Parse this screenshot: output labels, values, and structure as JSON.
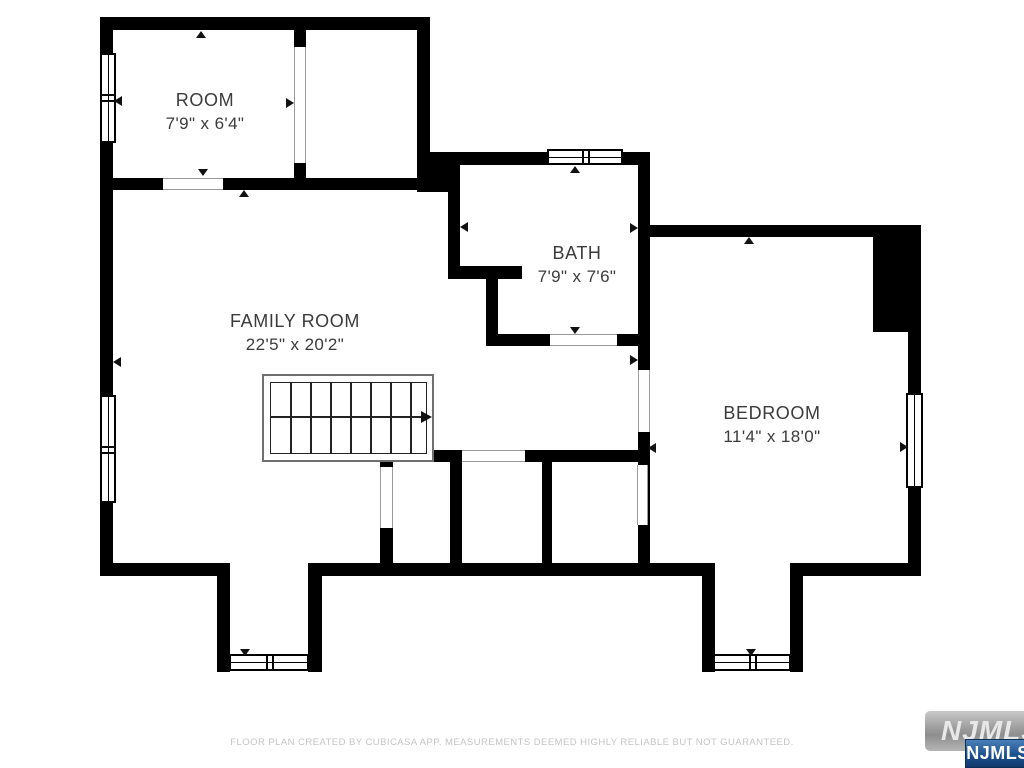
{
  "plan": {
    "rooms": [
      {
        "id": "room",
        "name": "ROOM",
        "dimensions": "7'9\" x 6'4\""
      },
      {
        "id": "bath",
        "name": "BATH",
        "dimensions": "7'9\" x 7'6\""
      },
      {
        "id": "family_room",
        "name": "FAMILY ROOM",
        "dimensions": "22'5\" x 20'2\""
      },
      {
        "id": "bedroom",
        "name": "BEDROOM",
        "dimensions": "11'4\" x 18'0\""
      }
    ],
    "features": [
      "staircase",
      "windows",
      "door-openings",
      "closets"
    ]
  },
  "footer": {
    "disclaimer": "FLOOR PLAN CREATED BY CUBICASA APP. MEASUREMENTS DEEMED HIGHLY RELIABLE BUT NOT GUARANTEED."
  },
  "branding": {
    "watermark_text": "NJMLS",
    "badge_text": "NJMLS"
  },
  "colors": {
    "wall": "#000000",
    "label_text": "#3b3b3b",
    "footer_text": "#c4c4c4",
    "watermark_gray": "#a0a0a0",
    "badge_blue_top": "#4a80b8",
    "badge_blue_bottom": "#123a6b"
  }
}
